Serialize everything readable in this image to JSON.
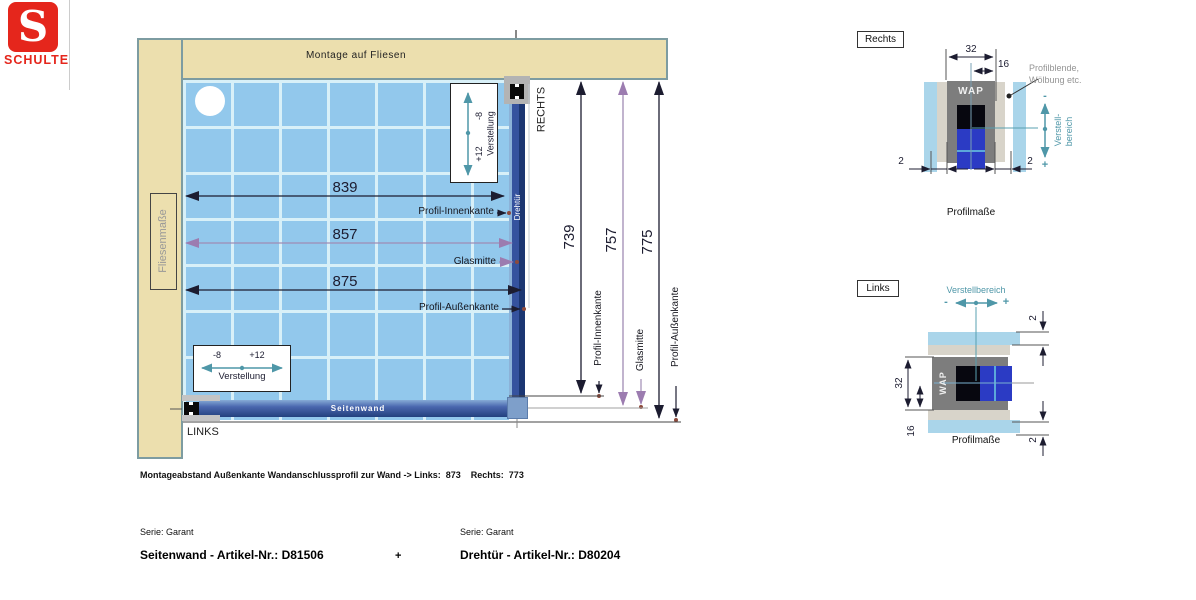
{
  "brand": {
    "name": "SCHULTE",
    "initial": "S"
  },
  "diagram": {
    "title": "Montage auf Fliesen",
    "wall_left_label": "Fliesenmaße",
    "side_right": "RECHTS",
    "side_left": "LINKS",
    "panel_bottom": "Seitenwand",
    "panel_right": "Drehtür",
    "adjust_top": {
      "minus": "-8",
      "plus": "+12",
      "label": "Verstellung"
    },
    "adjust_bottom": {
      "minus": "-8",
      "plus": "+12",
      "label": "Verstellung"
    },
    "width_dims": [
      {
        "value": "839",
        "label": "Profil-Innenkante"
      },
      {
        "value": "857",
        "label": "Glasmitte"
      },
      {
        "value": "875",
        "label": "Profil-Außenkante"
      }
    ],
    "height_dims": [
      {
        "value": "739",
        "label": "Profil-Innenkante"
      },
      {
        "value": "757",
        "label": "Glasmitte"
      },
      {
        "value": "775",
        "label": "Profil-Außenkante"
      }
    ]
  },
  "detail_right": {
    "title": "Rechts",
    "profile_label": "WAP",
    "dims": {
      "width": "32",
      "half": "16",
      "gap_left": "2",
      "gap_right": "2"
    },
    "note_line1": "Profilblende,",
    "note_line2": "Wölbung etc.",
    "adjust_line1": "Verstell-",
    "adjust_line2": "bereich",
    "minus": "-",
    "plus": "+",
    "caption": "Profilmaße"
  },
  "detail_left": {
    "title": "Links",
    "profile_label": "WAP",
    "adjust_label": "Verstellbereich",
    "dims": {
      "width": "32",
      "half": "16",
      "gap_top": "2",
      "gap_bottom": "2"
    },
    "minus": "-",
    "plus": "+",
    "caption": "Profilmaße"
  },
  "footer": {
    "note": "Montageabstand Außenkante Wandanschlussprofil zur Wand -> Links:  873    Rechts:  773",
    "left": {
      "serie": "Serie: Garant",
      "article": "Seitenwand - Artikel-Nr.: D81506"
    },
    "joiner": "+",
    "right": {
      "serie": "Serie: Garant",
      "article": "Drehtür - Artikel-Nr.: D80204"
    }
  },
  "colors": {
    "accent_red": "#e5261c",
    "wall_beige": "#ecdfae",
    "tile_blue": "#92c8ec",
    "profile_navy": "#22407e",
    "dim_purple": "#9c7cb0",
    "adjust_teal": "#4f97a8"
  }
}
